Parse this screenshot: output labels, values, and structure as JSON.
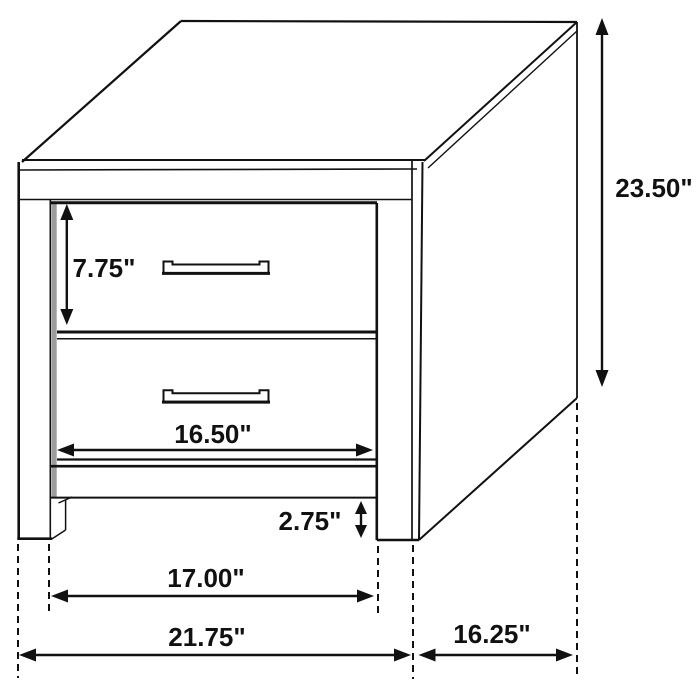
{
  "diagram": {
    "title": "Two-drawer nightstand dimension drawing",
    "type": "furniture-dimension-diagram",
    "units": "inches",
    "colors": {
      "line": "#111111",
      "background": "#ffffff",
      "reveal_shading": "#9c9c9c"
    },
    "labels": {
      "overall_height": "23.50\"",
      "top_drawer_height": "7.75\"",
      "drawer_front_width": "16.50\"",
      "base_clearance_height": "2.75\"",
      "inner_leg_span_width": "17.00\"",
      "overall_width": "21.75\"",
      "side_depth": "16.25\""
    }
  }
}
